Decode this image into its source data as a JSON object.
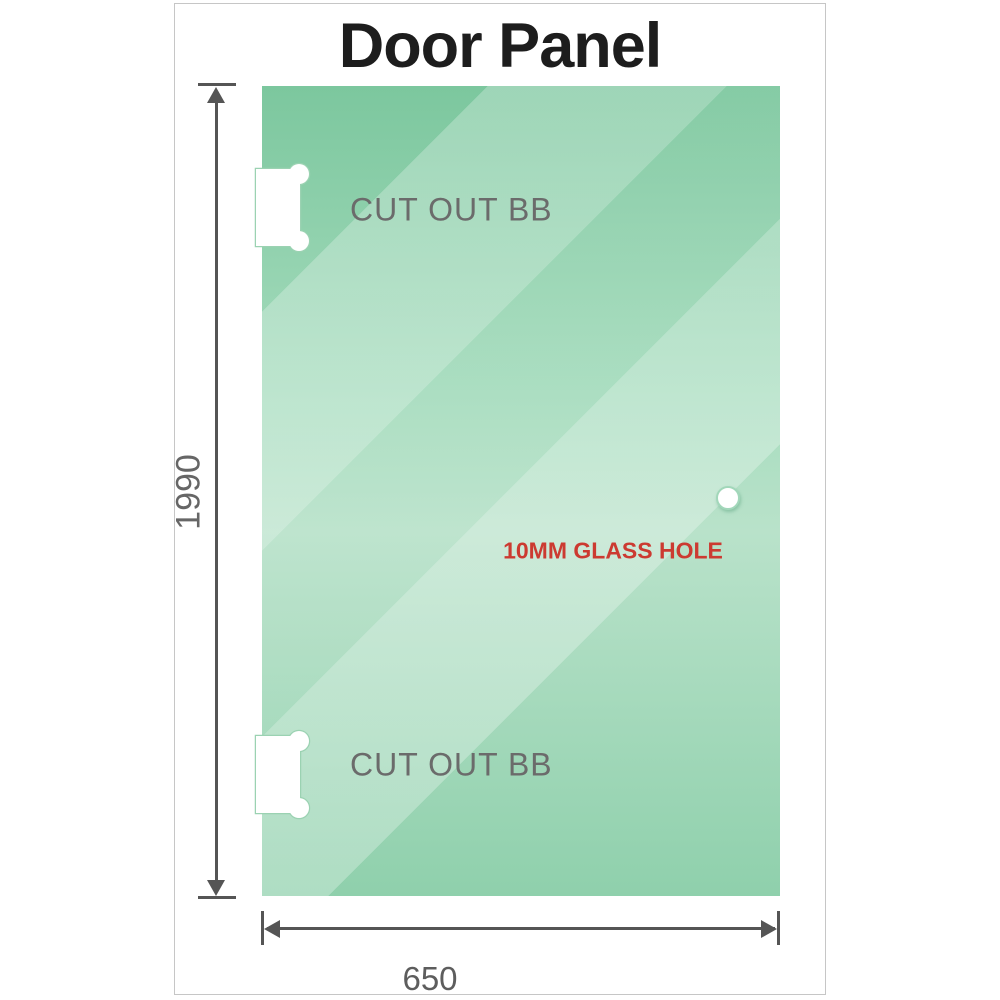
{
  "title": "Door Panel",
  "labels": {
    "cutout_top": "CUT OUT BB",
    "cutout_bottom": "CUT OUT BB",
    "glass_hole": "10MM GLASS HOLE"
  },
  "dimensions": {
    "height_mm": "1990",
    "width_mm": "650"
  },
  "colors": {
    "glass_top": "#7cc79e",
    "glass_mid": "#b9e2ca",
    "glass_bottom": "#8fd0ac",
    "dimension_gray": "#555555",
    "cutout_label_gray": "#6b6b6b",
    "hole_label_red": "#cc3a31",
    "title_black": "#1d1d1d",
    "card_border": "#c6c6c6"
  }
}
